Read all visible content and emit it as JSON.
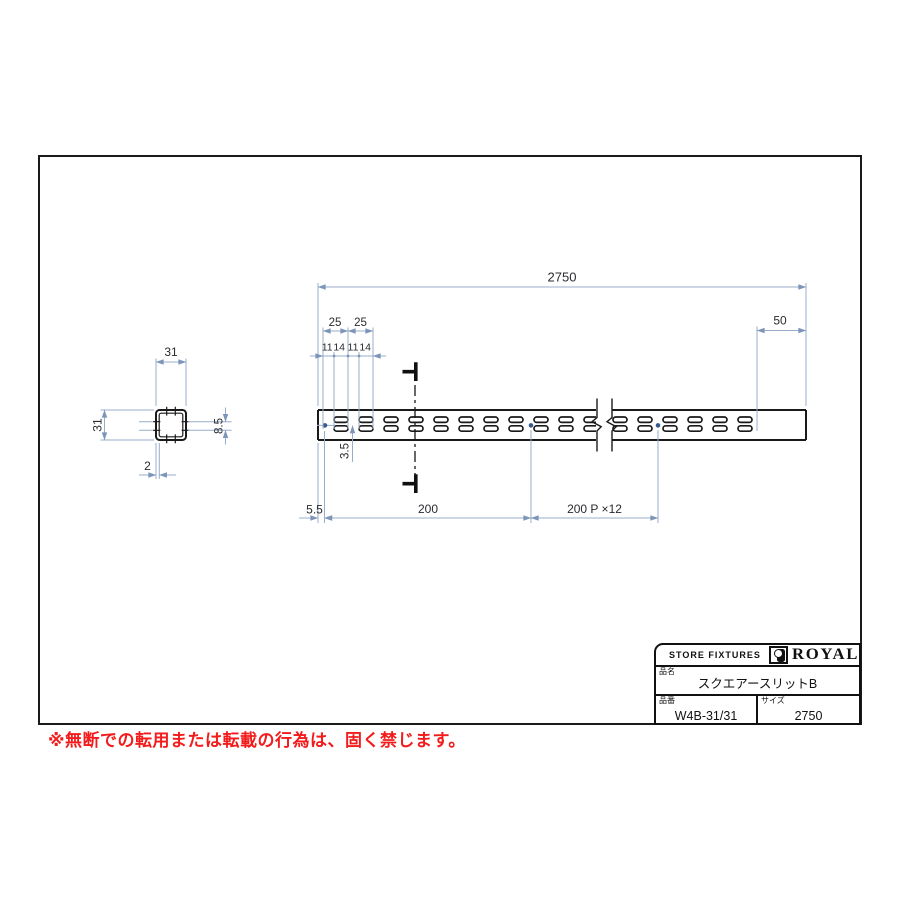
{
  "colors": {
    "draw_line": "#1a1a1a",
    "dim_line": "#98adcb",
    "dim_arrow": "#7d95b8",
    "dim_text": "#2b2b30",
    "center_dot": "#37598f",
    "warning_red": "#f31b1b"
  },
  "front_view": {
    "dim_total": "2750",
    "dim_end": "50",
    "dim_pitch_a": "25",
    "dim_pitch_b": "25",
    "dim_slot_1": "11",
    "dim_slot_2": "14",
    "dim_slot_3": "11",
    "dim_slot_4": "14",
    "dim_row_gap": "3.5",
    "dim_edge": "5.5",
    "dim_first_pitch": "200",
    "dim_repeat_pitch": "200 P ×12",
    "slots": {
      "before_break": {
        "start_x": 334,
        "pitch": 25,
        "count": 11
      },
      "after_break": {
        "start_x": 613,
        "pitch": 25,
        "count": 6
      },
      "width": 14,
      "height": 5.4,
      "rows_y": [
        417,
        425.8
      ]
    }
  },
  "section_view": {
    "dim_width": "31",
    "dim_height": "31",
    "dim_slot": "8.5",
    "dim_wall": "2"
  },
  "title_block": {
    "store_label": "STORE FIXTURES",
    "brand": "ROYAL",
    "name_label": "品名",
    "name_value": "スクエアースリットB",
    "number_label": "品番",
    "number_value": "W4B-31/31",
    "size_label": "サイズ",
    "size_value": "2750"
  },
  "footer": {
    "warning": "※無断での転用または転載の行為は、固く禁じます。"
  }
}
